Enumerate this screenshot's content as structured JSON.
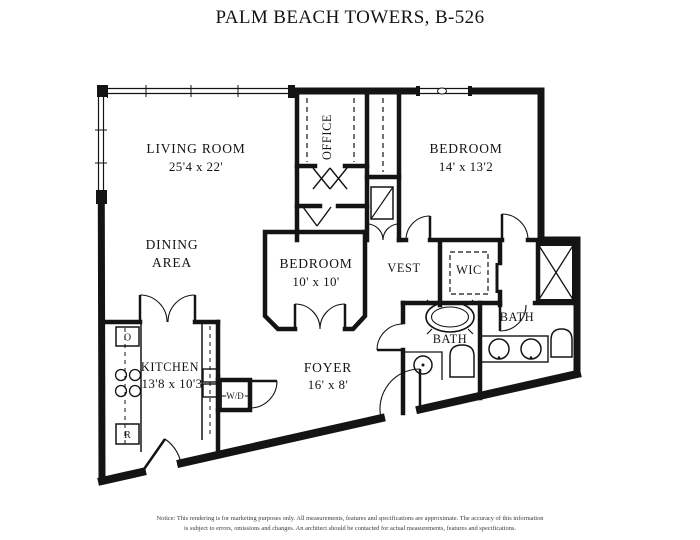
{
  "page": {
    "title": "PALM BEACH TOWERS, B-526",
    "background": "#ffffff",
    "line_color": "#141414"
  },
  "rooms": {
    "living_room": {
      "name": "LIVING ROOM",
      "dimensions": "25'4 x 22'"
    },
    "office": {
      "name": "OFFICE"
    },
    "bedroom_1": {
      "name": "BEDROOM",
      "dimensions": "14' x 13'2"
    },
    "dining_area": {
      "name_line1": "DINING",
      "name_line2": "AREA"
    },
    "bedroom_2": {
      "name": "BEDROOM",
      "dimensions": "10' x 10'"
    },
    "vestibule": {
      "name": "VEST"
    },
    "walk_in_closet": {
      "name": "WIC"
    },
    "bath_master": {
      "name": "BATH"
    },
    "bath_second": {
      "name": "BATH"
    },
    "kitchen": {
      "name": "KITCHEN",
      "dimensions": "13'8 x 10'3"
    },
    "foyer": {
      "name": "FOYER",
      "dimensions": "16' x 8'"
    }
  },
  "appliances": {
    "oven_label": "O",
    "refrigerator_label": "R",
    "washer_dryer_label": "W/D"
  },
  "notice": {
    "line1": "Notice: This rendering is for marketing purposes only. All measurements, features and specifications are approximate. The accuracy of this information",
    "line2": "is subject to errors, omissions and changes. An architect should be contacted for actual measurements, features and specifications."
  }
}
